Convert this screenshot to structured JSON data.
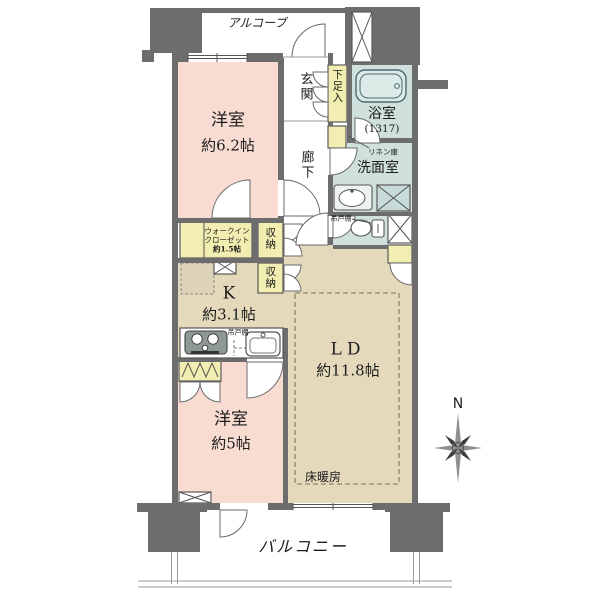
{
  "plan": {
    "labels": {
      "alcove": "アルコーブ",
      "entrance": "玄関",
      "shoe_cabinet": "下足入",
      "bathroom_name": "浴室",
      "bathroom_size": "(1317)",
      "linen_closet": "リネン庫",
      "washroom": "洗面室",
      "hallway": "廊下",
      "bedroom1_name": "洋室",
      "bedroom1_size": "約6.2帖",
      "wic_line1": "ウォークイン",
      "wic_line2": "クローゼット",
      "wic_line3": "約1.5帖",
      "storage1": "収納",
      "storage2": "収納",
      "hanging_cupboard_toilet": "吊戸棚",
      "hanging_cupboard_kitchen": "吊戸棚",
      "kitchen_name": "K",
      "kitchen_size": "約3.1帖",
      "living_dining_name": "LD",
      "living_dining_size": "約11.8帖",
      "bedroom2_name": "洋室",
      "bedroom2_size": "約5帖",
      "floor_heating": "床暖房",
      "balcony": "バルコニー"
    },
    "compass": {
      "north_label": "N"
    },
    "colors": {
      "wall": "#6d6d6d",
      "bedroom_fill": "#f8dcd2",
      "living_kitchen_fill": "#e4d9bb",
      "storage_fill": "#f2edb0",
      "wet_area_fill": "#cfe0dd",
      "bathtub_fill": "#dcebe8",
      "line": "#555555"
    }
  }
}
